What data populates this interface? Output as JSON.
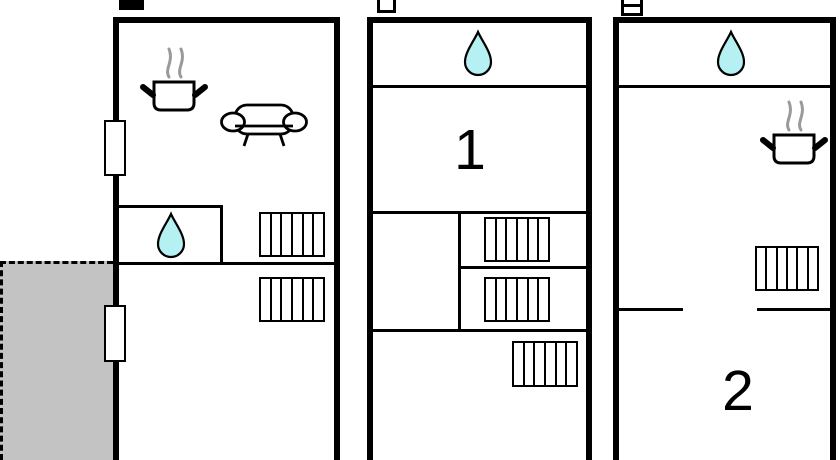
{
  "colors": {
    "wall": "#000000",
    "water": "#b5f0f2",
    "steam": "#9a9a9a",
    "terrace": "#c3c3c3",
    "background": "#ffffff"
  },
  "plans": [
    {
      "name": "left-plan",
      "level_icon": "filled-square-icon",
      "room_label": "",
      "features": [
        "stove-icon",
        "sofa-icon",
        "water-drop-icon",
        "window",
        "window",
        "stairs-icon",
        "stairs-icon",
        "terrace-area"
      ]
    },
    {
      "name": "middle-plan",
      "level_icon": "outline-square-icon",
      "room_label": "1",
      "features": [
        "water-drop-icon",
        "stairs-icon",
        "stairs-icon",
        "stairs-icon"
      ]
    },
    {
      "name": "right-plan",
      "level_icon": "stacked-squares-icon",
      "room_label": "2",
      "features": [
        "water-drop-icon",
        "stove-icon",
        "stairs-icon"
      ]
    }
  ]
}
